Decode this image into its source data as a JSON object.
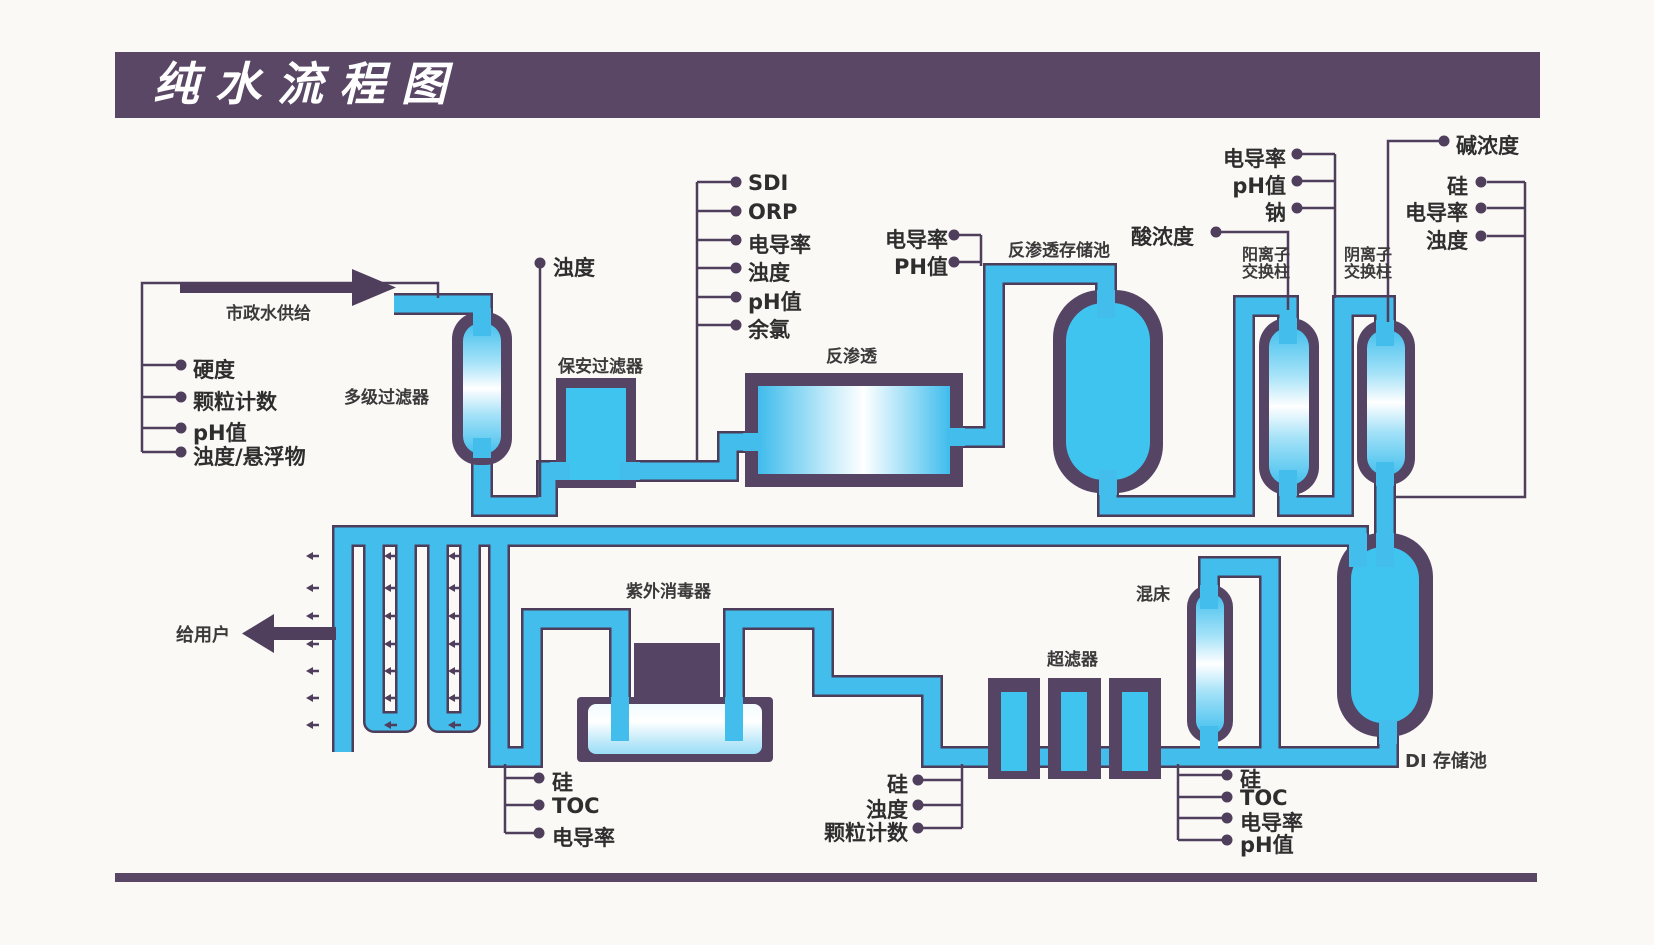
{
  "title": "纯水流程图",
  "colors": {
    "banner": "#5a4766",
    "pipe_fill": "#42bdec",
    "pipe_outline": "#4e3d5a",
    "vessel_purple": "#564465",
    "line_color": "#4f3e5c"
  },
  "equipment": {
    "feed_arrow": "市政水供给",
    "multi_stage_filter": "多级过滤器",
    "cartridge_filter": "保安过滤器",
    "reverse_osmosis": "反渗透",
    "ro_storage_tank": "反渗透存储池",
    "cation_column_line1": "阳离子",
    "cation_column_line2": "交换柱",
    "anion_column_line1": "阴离子",
    "anion_column_line2": "交换柱",
    "mixed_bed": "混床",
    "uv_sterilizer": "紫外消毒器",
    "ultrafilter": "超滤器",
    "di_storage_tank": "DI 存储池",
    "to_user": "给用户"
  },
  "monitors": {
    "feed": [
      "硬度",
      "颗粒计数",
      "pH值",
      "浊度/悬浮物"
    ],
    "after_filter": "浊度",
    "before_ro": [
      "SDI",
      "ORP",
      "电导率",
      "浊度",
      "pH值",
      "余氯"
    ],
    "after_ro": [
      "电导率",
      "PH值"
    ],
    "acid": "酸浓度",
    "after_cation": [
      "电导率",
      "pH值",
      "钠"
    ],
    "alkali": "碱浓度",
    "after_anion": [
      "硅",
      "电导率",
      "浊度"
    ],
    "after_uv": [
      "硅",
      "TOC",
      "电导率"
    ],
    "after_ultrafilter": [
      "硅",
      "浊度",
      "颗粒计数"
    ],
    "after_mixed_bed": [
      "硅",
      "TOC",
      "电导率",
      "pH值"
    ]
  }
}
